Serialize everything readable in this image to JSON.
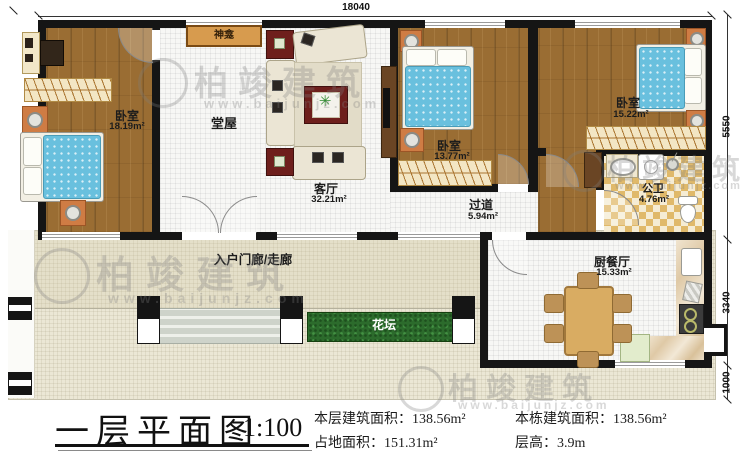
{
  "plan": {
    "title": "一层平面图",
    "scale": "1:100",
    "stats": [
      {
        "label": "本层建筑面积：",
        "value": "138.56m²"
      },
      {
        "label": "占地面积：",
        "value": "151.31m²"
      },
      {
        "label": "本栋建筑面积：",
        "value": "138.56m²"
      },
      {
        "label": "层高：",
        "value": "3.9m"
      }
    ]
  },
  "dimensions": {
    "top": "18040",
    "right_top": "5550",
    "right_middle": "3340",
    "right_bottom": "1000"
  },
  "rooms": [
    {
      "name": "卧室",
      "area": "18.19m²"
    },
    {
      "name": "堂屋",
      "area": ""
    },
    {
      "name": "客厅",
      "area": "32.21m²"
    },
    {
      "name": "卧室",
      "area": "13.77m²"
    },
    {
      "name": "卧室",
      "area": "15.22m²"
    },
    {
      "name": "过道",
      "area": "5.94m²"
    },
    {
      "name": "公卫",
      "area": "4.76m²"
    },
    {
      "name": "厨餐厅",
      "area": "15.33m²"
    },
    {
      "name": "入户门廊/走廊",
      "area": ""
    },
    {
      "name": "花坛",
      "area": ""
    },
    {
      "name": "神龛",
      "area": ""
    }
  ],
  "watermark": {
    "brand": "柏竣建筑",
    "url": "www.baijunjz.com"
  },
  "icons": {
    "plant": "✳"
  },
  "colors": {
    "wall": "#151515",
    "wood_floor": "#9a6d33",
    "mattress_blue": "#69c0de",
    "flower_bed_green": "#2c6b2c",
    "tile_tan": "#e0b96a",
    "accent_red": "#6e1f1c",
    "shrine_tan": "#d79b4e"
  }
}
